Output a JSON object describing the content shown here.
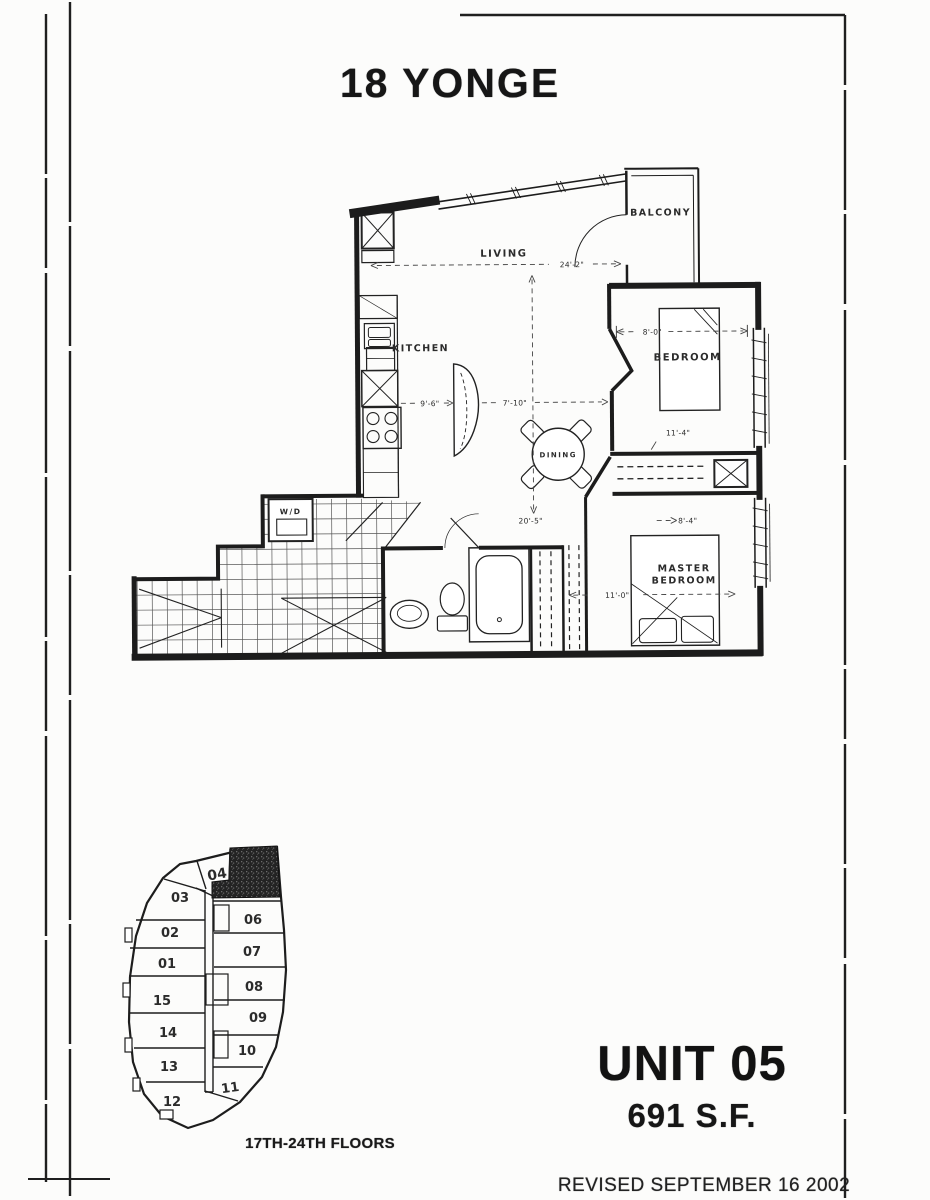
{
  "page": {
    "building_title": "18 YONGE",
    "unit_title": "UNIT 05",
    "unit_area": "691 S.F.",
    "revision_note": "REVISED SEPTEMBER 16 2002"
  },
  "floor_plan": {
    "rooms": {
      "living": "LIVING",
      "kitchen": "KITCHEN",
      "dining": "DINING",
      "balcony": "BALCONY",
      "bedroom": "BEDROOM",
      "master_bedroom_line1": "MASTER",
      "master_bedroom_line2": "BEDROOM",
      "laundry_closet": "W/D"
    },
    "dimensions": {
      "living_width": "24'-2\"",
      "kitchen_width": "9'-6\"",
      "dining_width": "7'-10\"",
      "living_depth": "20'-5\"",
      "bedroom_width": "8'-0\"",
      "bedroom_depth": "11'-4\"",
      "master_width": "8'-4\"",
      "master_depth": "11'-0\""
    }
  },
  "key_plan": {
    "floors_label": "17TH-24TH FLOORS",
    "highlighted_unit": "05",
    "units": [
      "04",
      "03",
      "02",
      "01",
      "15",
      "14",
      "13",
      "12",
      "06",
      "07",
      "08",
      "09",
      "10",
      "11"
    ]
  }
}
